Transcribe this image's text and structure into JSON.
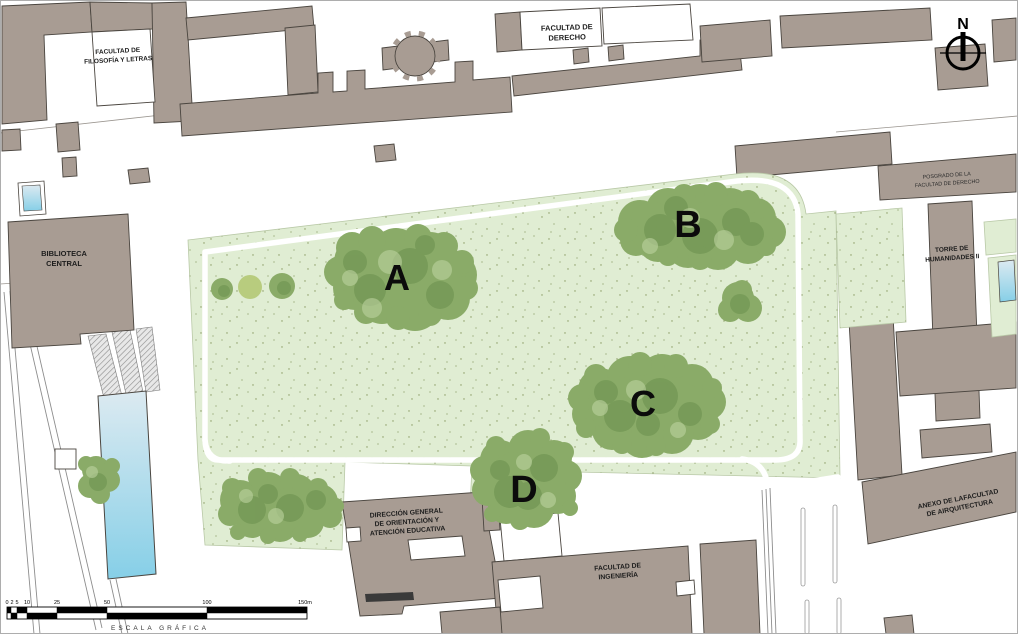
{
  "map_title": "Campus site plan with lawn zones A-D",
  "labels": {
    "filosofia": {
      "line1": "FACULTAD DE",
      "line2": "FILOSOFÍA Y LETRAS"
    },
    "derecho": {
      "line1": "FACULTAD DE",
      "line2": "DERECHO"
    },
    "posgrado": {
      "line1": "POSGRADO DE LA",
      "line2": "FACULTAD DE DERECHO"
    },
    "torre": {
      "line1": "TORRE DE",
      "line2": "HUMANIDADES II"
    },
    "biblioteca": {
      "line1": "BIBLIOTECA",
      "line2": "CENTRAL"
    },
    "anexo": {
      "line1": "ANEXO DE LAFACULTAD",
      "line2": "DE AIRQUITECTURA"
    },
    "dgose": {
      "line1": "DIRECCIÓN GENERAL",
      "line2": "DE ORIENTACIÓN Y",
      "line3": "ATENCIÓN EDUCATIVA"
    },
    "ingenieria": {
      "line1": "FACULTAD DE",
      "line2": "INGENIERÍA"
    }
  },
  "zones": {
    "a": "A",
    "b": "B",
    "c": "C",
    "d": "D"
  },
  "north": {
    "label": "N"
  },
  "scale": {
    "ticks": [
      "0",
      "2",
      "5",
      "10",
      "25",
      "50",
      "100",
      "150m"
    ],
    "caption": "ESCALA GRÁFICA"
  },
  "colors": {
    "building": "#a89c93",
    "building_outline": "#4a453f",
    "lawn": "#e0edd3",
    "tree": "#8aab68",
    "tree_dark": "#6a8f4d",
    "water": "#8ed2e9",
    "path": "#ffffff"
  }
}
